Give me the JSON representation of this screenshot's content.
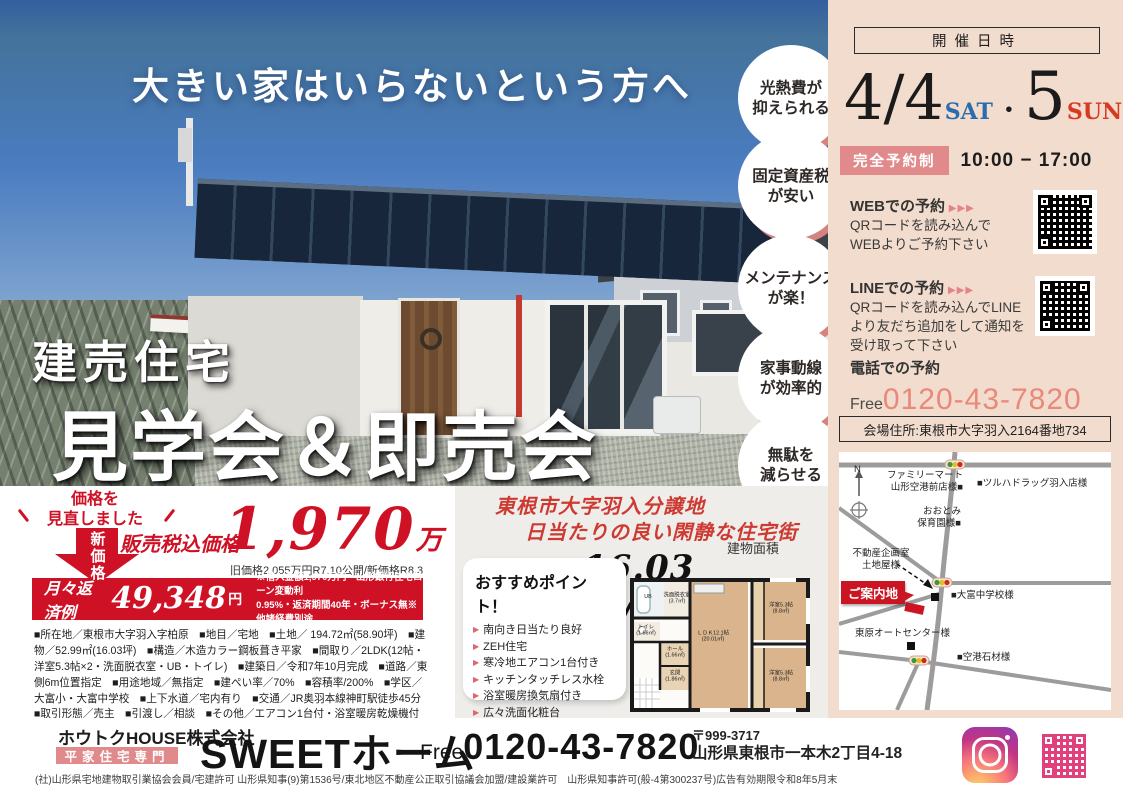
{
  "photo": {
    "headline": "大きい家はいらないという方へ",
    "title_small": "建売住宅",
    "title_large": "見学会＆即売会"
  },
  "benefits": [
    "光熱費が\n抑えられる",
    "固定資産税\nが安い",
    "メンテナンス\nが楽！",
    "家事動線\nが効率的",
    "無駄を\n減らせる"
  ],
  "event": {
    "header": "開催日時",
    "date1": "4/4",
    "day1": "SAT",
    "dot": "・",
    "date2": "5",
    "day2": "SUN",
    "badge": "完全予約制",
    "time": "10:00 − 17:00",
    "web_title": "WEBでの予約",
    "web_arrows": "▶▶▶",
    "web_body": "QRコードを読み込んで\nWEBよりご予約下さい",
    "line_title": "LINEでの予約",
    "line_arrows": "▶▶▶",
    "line_body": "QRコードを読み込んでLINE\nより友だち追加をして通知を\n受け取って下さい",
    "tel_title": "電話での予約",
    "tel_free": "Free",
    "tel_number": "0120-43-7820",
    "venue": "会場住所:東根市大字羽入2164番地734"
  },
  "map": {
    "compass": "N",
    "familymart": "ファミリーマート\n山形空港前店様■",
    "tsuruha": "■ツルハドラッグ羽入店様",
    "ootomi": "おおとみ\n保育園様■",
    "fudosan": "不動産企画室\n土地屋様",
    "chugakko": "■大富中学校様",
    "guide": "ご案内地",
    "autocenter": "東原オートセンター様",
    "sekizai": "■空港石材様"
  },
  "price": {
    "revise": "価格を\n見直しました",
    "new_label": "新価格",
    "price_label": "販売税込価格",
    "price_value": "1,970",
    "price_unit": "万円",
    "old_note": "旧価格2,055万円R7.10公開/新価格R8.3",
    "monthly_label": "月々返済例",
    "monthly_value": "49,348",
    "monthly_unit": "円",
    "loan_note": "※借入金額1,970万円・山形銀行住宅ローン変動利\n0.95%・返済期間40年・ボーナス無※他諸経費別途",
    "details": "■所在地／東根市大字羽入字柏原　■地目／宅地　■土地／ 194.72㎡(58.90坪)　■建物／52.99㎡(16.03坪)　■構造／木造カラー鋼板葺き平家　■間取り／2LDK(12帖・洋室5.3帖×2・洗面脱衣室・UB・トイレ)　■建築日／令和7年10月完成　■道路／東側6m位置指定　■用途地域／無指定　■建ぺい率／70%　■容積率/200%　■学区／大富小・大富中学校　■上下水道／宅内有り　■交通／JR奥羽本線神町駅徒歩45分　■取引形態／売主　■引渡し／相談　■その他／エアコン1台付・浴室暖房乾燥機付き・ZEH Oriented(BELS)取得適合住宅　※確認申請番号/第R07ASC-00016号"
  },
  "middle": {
    "catch1": "東根市大字羽入分譲地",
    "catch2": "日当たりの良い閑静な住宅街",
    "area_label": "建物面積",
    "area_value": "16.03坪/2LDK",
    "points_title": "おすすめポイント！",
    "points_bullet": "▶",
    "points": [
      "南向き日当たり良好",
      "ZEH住宅",
      "寒冷地エアコン1台付き",
      "キッチンタッチレス水栓",
      "浴室暖房換気扇付き",
      "広々洗面化粧台",
      "玄関コート掛け"
    ]
  },
  "floorplan": {
    "ldk": "ＬＤＫ12.1帖\n(20.01㎡)",
    "room1": "洋室5.3帖\n(8.8㎡)",
    "room2": "洋室5.3帖\n(8.8㎡)",
    "ub": "UB",
    "senmen": "洗面脱衣室\n(3.7㎡)",
    "toilet": "トイレ\n(1.66㎡)",
    "hall": "ホール\n(1.66㎡)",
    "genkan": "玄関\n(1.86㎡)"
  },
  "footer": {
    "company": "ホウトクHOUSE株式会社",
    "specialty": "平家住宅専門",
    "brand": "SWEETホーム",
    "free": "Free",
    "phone": "0120-43-7820",
    "postal": "〒999-3717",
    "address": "山形県東根市一本木2丁目4-18",
    "legal": "(社)山形県宅地建物取引業協会会員/宅建許可 山形県知事(9)第1536号/東北地区不動産公正取引協議会加盟/建設業許可　山形県知事許可(般-4第300237号)広告有効期限令和8年5月末"
  },
  "colors": {
    "accent_red": "#cf1126",
    "panel_pink": "#f2dccd",
    "badge_pink": "#e18a8c",
    "phone_coral": "#e9897b",
    "sat_blue": "#2b6cac",
    "sun_red": "#d63a23"
  }
}
